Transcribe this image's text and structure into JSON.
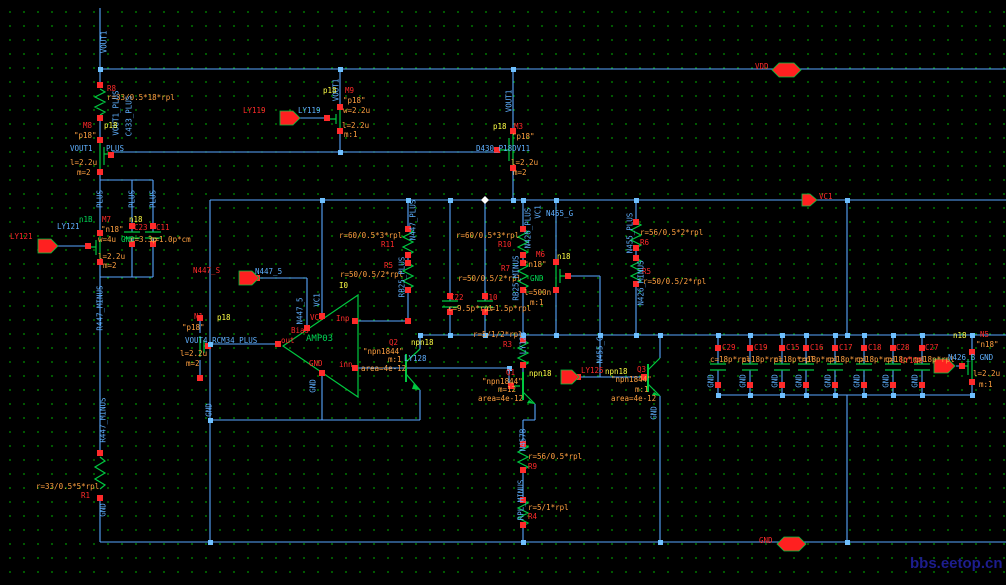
{
  "app": {
    "type": "schematic-editor",
    "watermark": "bbs.eetop.cn"
  },
  "colors": {
    "background": "#000000",
    "grid_dots": "#00a800",
    "wire": "#58a6ff",
    "device_symbol": "#00c840",
    "terminal": "#ff2a2a",
    "property_text": "#ffa040",
    "model_text": "#ffff45",
    "net_text": "#5fb0ff",
    "watermark": "#1d1d8e"
  },
  "labels": [
    {
      "n": "net-vout1-vertical-1",
      "t": "VOUT1",
      "x": 104,
      "y": 42,
      "c": "c",
      "v": 1
    },
    {
      "n": "r8-name",
      "t": "R8",
      "x": 107,
      "y": 85,
      "c": "r"
    },
    {
      "n": "r8-value",
      "t": "r=33/0.5*18*rpl",
      "x": 107,
      "y": 94,
      "c": "o"
    },
    {
      "n": "net-vout1plus-vertical",
      "t": "VOUT1_PLUS",
      "x": 116,
      "y": 113,
      "c": "c",
      "v": 1
    },
    {
      "n": "net-c433plus-vertical",
      "t": "C433_PLUS",
      "x": 129,
      "y": 116,
      "c": "c",
      "v": 1
    },
    {
      "n": "m8-name",
      "t": "M8",
      "x": 83,
      "y": 122,
      "c": "r"
    },
    {
      "n": "m8-model",
      "t": "p18",
      "x": 104,
      "y": 122,
      "c": "y"
    },
    {
      "n": "m8-model-quoted",
      "t": "\"p18\"",
      "x": 74,
      "y": 132,
      "c": "o"
    },
    {
      "n": "net-vout1-label",
      "t": "VOUT1",
      "x": 70,
      "y": 145,
      "c": "c"
    },
    {
      "n": "net-plus-label",
      "t": "PLUS",
      "x": 106,
      "y": 145,
      "c": "c"
    },
    {
      "n": "m8-length",
      "t": "l=2.2u",
      "x": 70,
      "y": 159,
      "c": "o"
    },
    {
      "n": "m8-mult",
      "t": "m=2",
      "x": 77,
      "y": 169,
      "c": "o"
    },
    {
      "n": "net-plus-vertical-1",
      "t": "PLUS",
      "x": 100,
      "y": 199,
      "c": "c",
      "v": 1
    },
    {
      "n": "net-plus-vertical-2",
      "t": "PLUS",
      "x": 132,
      "y": 199,
      "c": "c",
      "v": 1
    },
    {
      "n": "net-plus-vertical-3",
      "t": "PLUS",
      "x": 153,
      "y": 199,
      "c": "c",
      "v": 1
    },
    {
      "n": "m7-bulk-net",
      "t": "n1B",
      "x": 79,
      "y": 216,
      "c": "g"
    },
    {
      "n": "m7-name",
      "t": "M7",
      "x": 102,
      "y": 216,
      "c": "r"
    },
    {
      "n": "m7-model",
      "t": "n18",
      "x": 129,
      "y": 216,
      "c": "y"
    },
    {
      "n": "c23-name",
      "t": "C23",
      "x": 134,
      "y": 224,
      "c": "r"
    },
    {
      "n": "c11-name",
      "t": "C11",
      "x": 156,
      "y": 224,
      "c": "r"
    },
    {
      "n": "m7-model-quoted",
      "t": "\"n18\"",
      "x": 101,
      "y": 226,
      "c": "o"
    },
    {
      "n": "m7-width",
      "t": "w=4u",
      "x": 98,
      "y": 236,
      "c": "o"
    },
    {
      "n": "m7-bulk",
      "t": "GND",
      "x": 121,
      "y": 236,
      "c": "g"
    },
    {
      "n": "c23-value",
      "t": "c=3.3p",
      "x": 130,
      "y": 236,
      "c": "o"
    },
    {
      "n": "c11-value",
      "t": "c=1.0p*cm",
      "x": 150,
      "y": 236,
      "c": "o"
    },
    {
      "n": "m7-length",
      "t": "l=2.2u",
      "x": 98,
      "y": 253,
      "c": "o"
    },
    {
      "n": "m7-mult",
      "t": "m=2",
      "x": 103,
      "y": 262,
      "c": "o"
    },
    {
      "n": "ly121-pin-label",
      "t": "LY121",
      "x": 10,
      "y": 233,
      "c": "r"
    },
    {
      "n": "ly121-net-label",
      "t": "LY121",
      "x": 57,
      "y": 223,
      "c": "c"
    },
    {
      "n": "net-r447minus-vertical-1",
      "t": "R447_MINUS",
      "x": 100,
      "y": 308,
      "c": "c",
      "v": 1
    },
    {
      "n": "net-r447minus-vertical-2",
      "t": "R447_MINUS",
      "x": 103,
      "y": 420,
      "c": "c",
      "v": 1
    },
    {
      "n": "r1-value",
      "t": "r=33/0.5*5*rpl",
      "x": 36,
      "y": 483,
      "c": "o"
    },
    {
      "n": "r1-name",
      "t": "R1",
      "x": 81,
      "y": 492,
      "c": "r"
    },
    {
      "n": "net-gnd-vertical-left",
      "t": "GND",
      "x": 103,
      "y": 510,
      "c": "c",
      "v": 1
    },
    {
      "n": "ly119-pin-label",
      "t": "LY119",
      "x": 243,
      "y": 107,
      "c": "r"
    },
    {
      "n": "ly119-net-label",
      "t": "LY119",
      "x": 298,
      "y": 107,
      "c": "c"
    },
    {
      "n": "net-vout1-vertical-2",
      "t": "VOUT1",
      "x": 336,
      "y": 90,
      "c": "c",
      "v": 1
    },
    {
      "n": "m9-model",
      "t": "p18",
      "x": 323,
      "y": 87,
      "c": "y"
    },
    {
      "n": "m9-name",
      "t": "M9",
      "x": 345,
      "y": 87,
      "c": "r"
    },
    {
      "n": "m9-model-quoted",
      "t": "\"p18\"",
      "x": 343,
      "y": 97,
      "c": "o"
    },
    {
      "n": "m9-width",
      "t": "w=2.2u",
      "x": 343,
      "y": 107,
      "c": "o"
    },
    {
      "n": "m9-length",
      "t": "l=2.2u",
      "x": 342,
      "y": 122,
      "c": "o"
    },
    {
      "n": "m9-mult",
      "t": "m:1",
      "x": 344,
      "y": 131,
      "c": "o"
    },
    {
      "n": "net-vout1-vertical-3",
      "t": "VOUT1",
      "x": 509,
      "y": 101,
      "c": "c",
      "v": 1
    },
    {
      "n": "m3-model",
      "t": "p18",
      "x": 493,
      "y": 123,
      "c": "y"
    },
    {
      "n": "m3-name",
      "t": "M3",
      "x": 514,
      "y": 123,
      "c": "r"
    },
    {
      "n": "m3-model-quoted",
      "t": "\"p18\"",
      "x": 512,
      "y": 133,
      "c": "o"
    },
    {
      "n": "net-d430-label",
      "t": "D430_P18DV11",
      "x": 476,
      "y": 145,
      "c": "c"
    },
    {
      "n": "m3-length",
      "t": "l=2.2u",
      "x": 511,
      "y": 159,
      "c": "o"
    },
    {
      "n": "m3-mult",
      "t": "m=2",
      "x": 513,
      "y": 169,
      "c": "o"
    },
    {
      "n": "n447s-pin-label",
      "t": "N447_S",
      "x": 193,
      "y": 267,
      "c": "r"
    },
    {
      "n": "n447s-net-label",
      "t": "N447_5",
      "x": 255,
      "y": 268,
      "c": "c"
    },
    {
      "n": "net-n447-vertical",
      "t": "N447_5",
      "x": 300,
      "y": 311,
      "c": "c",
      "v": 1
    },
    {
      "n": "net-vc1-vertical-opamp",
      "t": "VC1",
      "x": 317,
      "y": 300,
      "c": "c",
      "v": 1
    },
    {
      "n": "opamp-instance",
      "t": "I0",
      "x": 339,
      "y": 282,
      "c": "y"
    },
    {
      "n": "opamp-pin-vc1",
      "t": "VC1",
      "x": 310,
      "y": 314,
      "c": "r"
    },
    {
      "n": "opamp-pin-inp",
      "t": "Inp",
      "x": 336,
      "y": 315,
      "c": "r"
    },
    {
      "n": "opamp-pin-bias",
      "t": "Bias",
      "x": 291,
      "y": 327,
      "c": "r"
    },
    {
      "n": "opamp-pin-out",
      "t": "out",
      "x": 281,
      "y": 337,
      "c": "r"
    },
    {
      "n": "opamp-name",
      "t": "AMP03",
      "x": 306,
      "y": 335,
      "c": "g",
      "fs": 9
    },
    {
      "n": "opamp-pin-gnd",
      "t": "GND",
      "x": 309,
      "y": 360,
      "c": "r"
    },
    {
      "n": "opamp-pin-inn",
      "t": "inn",
      "x": 339,
      "y": 361,
      "c": "r"
    },
    {
      "n": "net-gnd-vertical-opamp",
      "t": "GND",
      "x": 313,
      "y": 386,
      "c": "c",
      "v": 1
    },
    {
      "n": "n1-name",
      "t": "N1",
      "x": 194,
      "y": 313,
      "c": "r"
    },
    {
      "n": "n1-model",
      "t": "p18",
      "x": 217,
      "y": 314,
      "c": "y"
    },
    {
      "n": "n1-model-quoted",
      "t": "\"p18\"",
      "x": 182,
      "y": 324,
      "c": "o"
    },
    {
      "n": "net-vout4-label",
      "t": "VOUT4 RCM34 PLUS",
      "x": 185,
      "y": 337,
      "c": "c"
    },
    {
      "n": "n1-length",
      "t": "l=2.2u",
      "x": 180,
      "y": 350,
      "c": "o"
    },
    {
      "n": "n1-mult",
      "t": "m=2",
      "x": 186,
      "y": 360,
      "c": "o"
    },
    {
      "n": "net-gnd-vertical-n1",
      "t": "GND",
      "x": 209,
      "y": 410,
      "c": "c",
      "v": 1
    },
    {
      "n": "net-n447plus-vertical",
      "t": "N447_PLUS",
      "x": 413,
      "y": 220,
      "c": "c",
      "v": 1
    },
    {
      "n": "r11-value",
      "t": "r=60/0.5*3*rpl",
      "x": 339,
      "y": 232,
      "c": "o"
    },
    {
      "n": "r11-name",
      "t": "R11",
      "x": 381,
      "y": 241,
      "c": "r"
    },
    {
      "n": "r5-name",
      "t": "R5",
      "x": 384,
      "y": 262,
      "c": "r"
    },
    {
      "n": "r5-value",
      "t": "r=50/0.5/2*rpl",
      "x": 340,
      "y": 271,
      "c": "o"
    },
    {
      "n": "net-rb25plus-vertical",
      "t": "RB25_PLUS",
      "x": 402,
      "y": 277,
      "c": "c",
      "v": 1
    },
    {
      "n": "net-n426plus-vertical",
      "t": "N426_PLUS",
      "x": 528,
      "y": 228,
      "c": "c",
      "v": 1
    },
    {
      "n": "r10-value",
      "t": "r=60/0.5*3*rpl",
      "x": 456,
      "y": 232,
      "c": "o"
    },
    {
      "n": "r10-name",
      "t": "R10",
      "x": 498,
      "y": 241,
      "c": "r"
    },
    {
      "n": "r7-name",
      "t": "R7",
      "x": 501,
      "y": 265,
      "c": "r"
    },
    {
      "n": "r7-value",
      "t": "r=50/0.5/2*rpl",
      "x": 458,
      "y": 275,
      "c": "o"
    },
    {
      "n": "net-rb25minus-vertical",
      "t": "RB25_MINUS",
      "x": 516,
      "y": 278,
      "c": "c",
      "v": 1
    },
    {
      "n": "c22-name",
      "t": "C22",
      "x": 450,
      "y": 294,
      "c": "r"
    },
    {
      "n": "c10-name",
      "t": "C10",
      "x": 484,
      "y": 294,
      "c": "r"
    },
    {
      "n": "c22-value",
      "t": "c=9.5p*rpl",
      "x": 448,
      "y": 305,
      "c": "o"
    },
    {
      "n": "c10-value",
      "t": "c=1.5p*rpl",
      "x": 486,
      "y": 305,
      "c": "o"
    },
    {
      "n": "n455g-net-label",
      "t": "N455_G",
      "x": 546,
      "y": 210,
      "c": "c"
    },
    {
      "n": "net-vc1-vertical-rail",
      "t": "VC1",
      "x": 538,
      "y": 212,
      "c": "c",
      "v": 1
    },
    {
      "n": "m6-name",
      "t": "M6",
      "x": 536,
      "y": 251,
      "c": "r"
    },
    {
      "n": "m6-model",
      "t": "n18",
      "x": 557,
      "y": 253,
      "c": "y"
    },
    {
      "n": "m6-model-quoted",
      "t": "\"n18\"",
      "x": 524,
      "y": 261,
      "c": "o"
    },
    {
      "n": "m6-bulk",
      "t": "GND",
      "x": 530,
      "y": 275,
      "c": "g"
    },
    {
      "n": "m6-length",
      "t": "l=500n",
      "x": 524,
      "y": 289,
      "c": "o"
    },
    {
      "n": "m6-mult",
      "t": "m:1",
      "x": 530,
      "y": 299,
      "c": "o"
    },
    {
      "n": "net-n455plus-vertical",
      "t": "N455_PLUS",
      "x": 630,
      "y": 233,
      "c": "c",
      "v": 1
    },
    {
      "n": "r6-value",
      "t": "r=56/0.5*2*rpl",
      "x": 640,
      "y": 229,
      "c": "o"
    },
    {
      "n": "r6-name",
      "t": "R6",
      "x": 640,
      "y": 239,
      "c": "r"
    },
    {
      "n": "r5b-name",
      "t": "R5",
      "x": 642,
      "y": 268,
      "c": "r"
    },
    {
      "n": "r5b-value",
      "t": "r=50/0.5/2*rpl",
      "x": 643,
      "y": 278,
      "c": "o"
    },
    {
      "n": "net-n426minus-vertical",
      "t": "N426_MINUS",
      "x": 641,
      "y": 283,
      "c": "c",
      "v": 1
    },
    {
      "n": "net-ly128-vertical",
      "t": "LY128",
      "x": 523,
      "y": 343,
      "c": "c",
      "v": 1
    },
    {
      "n": "net-ly128-label",
      "t": "LY128",
      "x": 404,
      "y": 355,
      "c": "c"
    },
    {
      "n": "q2-name",
      "t": "Q2",
      "x": 389,
      "y": 339,
      "c": "r"
    },
    {
      "n": "q2-model",
      "t": "npn18",
      "x": 411,
      "y": 339,
      "c": "y"
    },
    {
      "n": "q2-model-quoted",
      "t": "\"npn1844\"",
      "x": 363,
      "y": 348,
      "c": "o"
    },
    {
      "n": "q2-mult",
      "t": "m:1",
      "x": 388,
      "y": 356,
      "c": "o"
    },
    {
      "n": "q2-area",
      "t": "area=4e-12",
      "x": 361,
      "y": 365,
      "c": "o"
    },
    {
      "n": "r3-value",
      "t": "r=5/1/2*rpl",
      "x": 473,
      "y": 331,
      "c": "o"
    },
    {
      "n": "r3-name",
      "t": "R3",
      "x": 503,
      "y": 341,
      "c": "r"
    },
    {
      "n": "q1-name",
      "t": "Q1",
      "x": 506,
      "y": 369,
      "c": "r"
    },
    {
      "n": "q1-model",
      "t": "npn18",
      "x": 529,
      "y": 370,
      "c": "y"
    },
    {
      "n": "q1-model-quoted",
      "t": "\"npn1844\"",
      "x": 482,
      "y": 378,
      "c": "o"
    },
    {
      "n": "q1-mult",
      "t": "m=12",
      "x": 498,
      "y": 386,
      "c": "o"
    },
    {
      "n": "q1-area",
      "t": "area=4e-12",
      "x": 478,
      "y": 395,
      "c": "o"
    },
    {
      "n": "ly125-pin-label",
      "t": "LY125",
      "x": 581,
      "y": 367,
      "c": "r"
    },
    {
      "n": "q3-model",
      "t": "npn18",
      "x": 605,
      "y": 368,
      "c": "y"
    },
    {
      "n": "q3-name",
      "t": "Q3",
      "x": 637,
      "y": 366,
      "c": "r"
    },
    {
      "n": "net-n455g-vertical",
      "t": "N455_G",
      "x": 600,
      "y": 350,
      "c": "c",
      "v": 1
    },
    {
      "n": "q3-model-quoted",
      "t": "\"npn1844\"",
      "x": 611,
      "y": 376,
      "c": "o"
    },
    {
      "n": "q3-mult",
      "t": "m:1",
      "x": 635,
      "y": 386,
      "c": "o"
    },
    {
      "n": "q3-area",
      "t": "area=4e-12",
      "x": 611,
      "y": 395,
      "c": "o"
    },
    {
      "n": "net-gnd-vertical-q3",
      "t": "GND",
      "x": 654,
      "y": 413,
      "c": "c",
      "v": 1
    },
    {
      "n": "net-n457b-vertical",
      "t": "N457B",
      "x": 523,
      "y": 440,
      "c": "c",
      "v": 1
    },
    {
      "n": "r9-value",
      "t": "r=56/0.5*rpl",
      "x": 528,
      "y": 453,
      "c": "o"
    },
    {
      "n": "r9-name",
      "t": "R9",
      "x": 528,
      "y": 463,
      "c": "r"
    },
    {
      "n": "net-rplminus-vertical",
      "t": "RPL_MINUS",
      "x": 521,
      "y": 500,
      "c": "c",
      "v": 1
    },
    {
      "n": "r4-value",
      "t": "r=5/1*rpl",
      "x": 528,
      "y": 504,
      "c": "o"
    },
    {
      "n": "r4-name",
      "t": "R4",
      "x": 528,
      "y": 513,
      "c": "r"
    },
    {
      "n": "vdd-pin-label",
      "t": "VDD",
      "x": 755,
      "y": 63,
      "c": "r"
    },
    {
      "n": "vc1-pin-label",
      "t": "VC1",
      "x": 819,
      "y": 193,
      "c": "r"
    },
    {
      "n": "gnd-pin-label",
      "t": "GND",
      "x": 759,
      "y": 537,
      "c": "r"
    },
    {
      "n": "c29-name",
      "t": "C29",
      "x": 722,
      "y": 344,
      "c": "r"
    },
    {
      "n": "c19-name",
      "t": "C19",
      "x": 754,
      "y": 344,
      "c": "r"
    },
    {
      "n": "c15-name",
      "t": "C15",
      "x": 786,
      "y": 344,
      "c": "r"
    },
    {
      "n": "c16-name",
      "t": "C16",
      "x": 810,
      "y": 344,
      "c": "r"
    },
    {
      "n": "c17-name",
      "t": "C17",
      "x": 839,
      "y": 344,
      "c": "r"
    },
    {
      "n": "c18-name",
      "t": "C18",
      "x": 868,
      "y": 344,
      "c": "r"
    },
    {
      "n": "c28-name",
      "t": "C28",
      "x": 896,
      "y": 344,
      "c": "r"
    },
    {
      "n": "c27-name",
      "t": "C27",
      "x": 925,
      "y": 344,
      "c": "r"
    },
    {
      "n": "c29-value",
      "t": "c=18p*rpl",
      "x": 710,
      "y": 356,
      "c": "o"
    },
    {
      "n": "c19-value",
      "t": "c=18p*rpl",
      "x": 742,
      "y": 356,
      "c": "o"
    },
    {
      "n": "c15-value",
      "t": "c=18p*rpl",
      "x": 774,
      "y": 356,
      "c": "o"
    },
    {
      "n": "c16-value",
      "t": "c=18p*rpl",
      "x": 798,
      "y": 356,
      "c": "o"
    },
    {
      "n": "c17-value",
      "t": "c=18p*rpl",
      "x": 827,
      "y": 356,
      "c": "o"
    },
    {
      "n": "c18-value",
      "t": "c=18p*rpl",
      "x": 856,
      "y": 356,
      "c": "o"
    },
    {
      "n": "c28-value",
      "t": "c=18p*rpl",
      "x": 885,
      "y": 356,
      "c": "o"
    },
    {
      "n": "c27-value",
      "t": "c=18p*rpl",
      "x": 914,
      "y": 356,
      "c": "o"
    },
    {
      "n": "net-gnd-vertical-c29",
      "t": "GND",
      "x": 711,
      "y": 381,
      "c": "c",
      "v": 1
    },
    {
      "n": "net-gnd-vertical-c19",
      "t": "GND",
      "x": 743,
      "y": 381,
      "c": "c",
      "v": 1
    },
    {
      "n": "net-gnd-vertical-c15",
      "t": "GND",
      "x": 775,
      "y": 381,
      "c": "c",
      "v": 1
    },
    {
      "n": "net-gnd-vertical-c16",
      "t": "GND",
      "x": 799,
      "y": 381,
      "c": "c",
      "v": 1
    },
    {
      "n": "net-gnd-vertical-c17",
      "t": "GND",
      "x": 828,
      "y": 381,
      "c": "c",
      "v": 1
    },
    {
      "n": "net-gnd-vertical-c18",
      "t": "GND",
      "x": 857,
      "y": 381,
      "c": "c",
      "v": 1
    },
    {
      "n": "net-gnd-vertical-c28",
      "t": "GND",
      "x": 886,
      "y": 381,
      "c": "c",
      "v": 1
    },
    {
      "n": "net-gnd-vertical-c27",
      "t": "GND",
      "x": 915,
      "y": 381,
      "c": "c",
      "v": 1
    },
    {
      "n": "ly126-pin-label",
      "t": "LY126",
      "x": 900,
      "y": 357,
      "c": "r"
    },
    {
      "n": "n5-model",
      "t": "n18",
      "x": 953,
      "y": 332,
      "c": "y"
    },
    {
      "n": "n5-name",
      "t": "N5",
      "x": 980,
      "y": 331,
      "c": "r"
    },
    {
      "n": "n5-model-quoted",
      "t": "\"n18\"",
      "x": 976,
      "y": 341,
      "c": "o"
    },
    {
      "n": "net-n426b-label",
      "t": "N426_B GND",
      "x": 948,
      "y": 354,
      "c": "c"
    },
    {
      "n": "n5-length",
      "t": "l=2.2u",
      "x": 973,
      "y": 370,
      "c": "o"
    },
    {
      "n": "n5-mult",
      "t": "m:1",
      "x": 979,
      "y": 381,
      "c": "o"
    },
    {
      "n": "watermark",
      "t": "bbs.eetop.cn",
      "x": 910,
      "y": 556,
      "c": "w",
      "fs": 15
    }
  ]
}
